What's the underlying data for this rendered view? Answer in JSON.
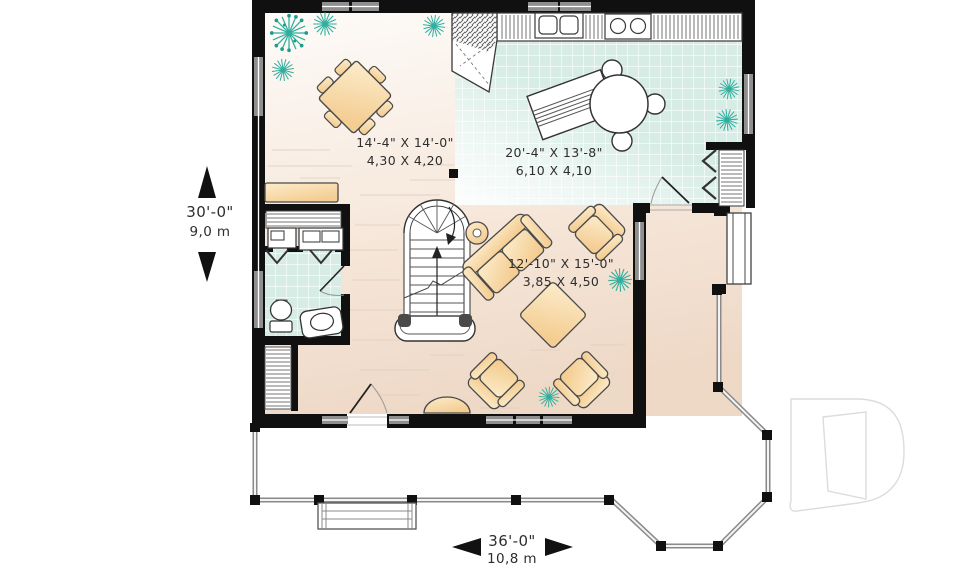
{
  "plan": {
    "logo_letter": "D",
    "dimensions": {
      "height": {
        "imperial": "30'-0\"",
        "metric": "9,0 m"
      },
      "width": {
        "imperial": "36'-0\"",
        "metric": "10,8 m"
      }
    },
    "rooms": {
      "dining": {
        "imperial": "14'-4\" X 14'-0\"",
        "metric": "4,30 X 4,20"
      },
      "kitchen": {
        "imperial": "20'-4\" X 13'-8\"",
        "metric": "6,10 X 4,10"
      },
      "living": {
        "imperial": "12'-10\" X 15'-0\"",
        "metric": "3,85 X 4,50"
      }
    },
    "colors": {
      "wall": "#101010",
      "tile": "#d6ece5",
      "furniture": "#f6d49c",
      "plant": "#2fae9e",
      "floor": "#f2dfd2",
      "railing": "#8a8a8a",
      "watermark": "#dcdcdc"
    }
  }
}
